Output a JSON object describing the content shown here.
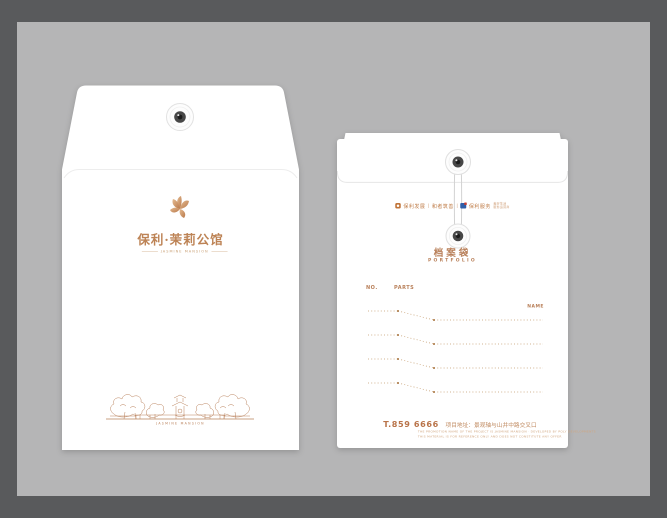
{
  "colors": {
    "copper_accent": "#b9805a",
    "copper_light": "#d8ab7e",
    "frame_background": "#595a5c",
    "mat_background": "#b5b5b6",
    "envelope_white": "#ffffff"
  },
  "front_envelope": {
    "logo_title": "保利·茉莉公馆",
    "logo_tagline": "JASMINE MANSION",
    "footer_caption": "JASMINE MANSION"
  },
  "back_envelope": {
    "brand_row": {
      "item1": "保利发展",
      "item2": "和者筑善",
      "item3": "保利服务",
      "item4_line1": "美好生活",
      "item4_line2": "服务运营商",
      "separator": "|"
    },
    "doc_label_cn": "档案袋",
    "doc_label_en": "PORTFOLIO",
    "form": {
      "col_no": "NO.",
      "col_parts": "PARTS",
      "col_name": "NAME",
      "row_count": 4
    },
    "contact": {
      "phone": "T.859 6666",
      "address": "项目地址：景观轴与山井中路交叉口",
      "disclaimer_line1": "THE PROMOTION NAME OF THE PROJECT IS JASMINE MANSION · DEVELOPED BY POLY DEVELOPMENTS",
      "disclaimer_line2": "THIS MATERIAL IS FOR REFERENCE ONLY AND DOES NOT CONSTITUTE ANY OFFER"
    }
  }
}
